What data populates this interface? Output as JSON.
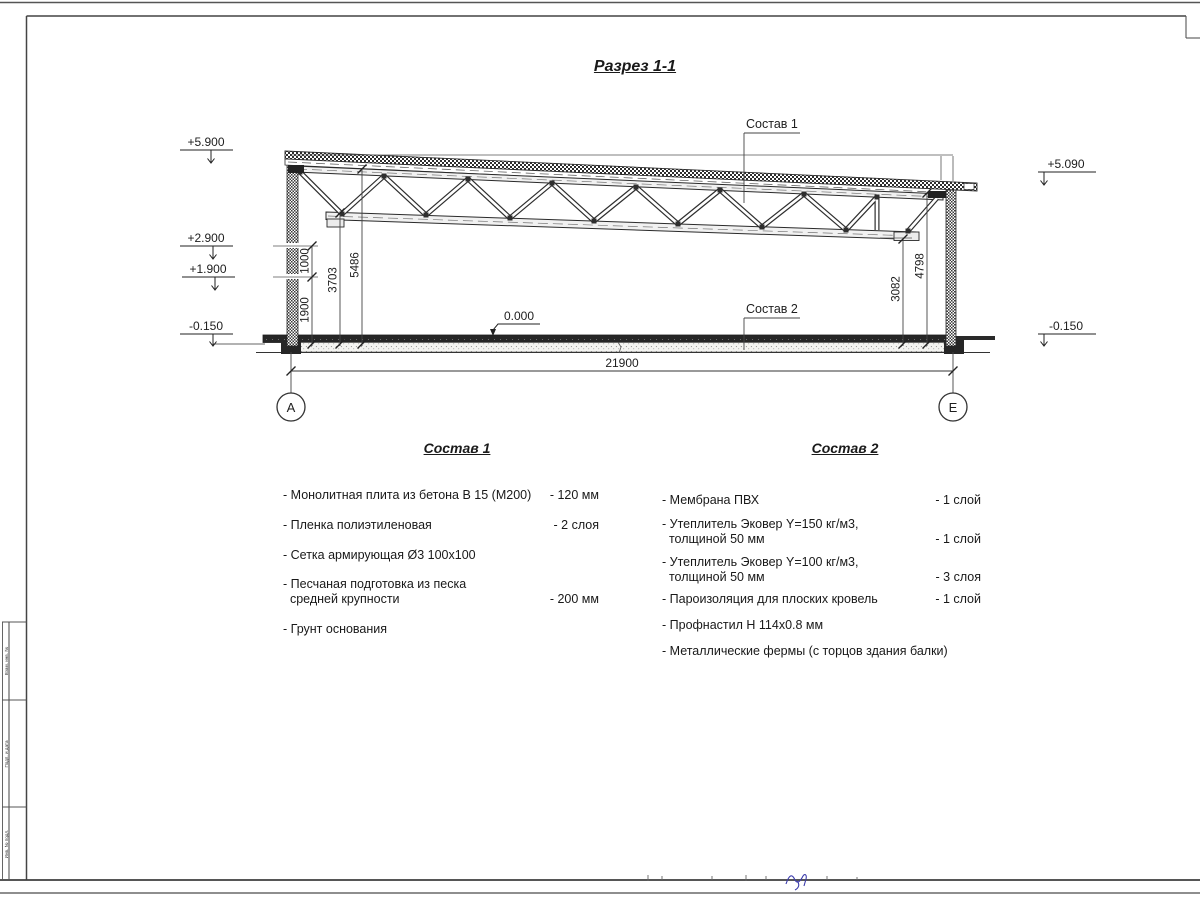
{
  "drawing": {
    "title": "Разрез 1-1",
    "labels": {
      "sostav1": "Состав 1",
      "sostav2": "Состав 2"
    },
    "elevations": {
      "left_top": "+5.900",
      "left_mid1": "+2.900",
      "left_mid2": "+1.900",
      "left_bottom": "-0.150",
      "right_top": "+5.090",
      "right_bottom": "-0.150",
      "floor_zero": "0.000"
    },
    "dimensions": {
      "total_width": "21900",
      "v1000": "1000",
      "v1900": "1900",
      "v3703": "3703",
      "v5486": "5486",
      "v3082": "3082",
      "v4798": "4798"
    },
    "axes": {
      "left": "А",
      "right": "Е"
    }
  },
  "spec1": {
    "heading": "Состав 1",
    "items": [
      {
        "name": "- Монолитная плита из бетона В 15 (М200)",
        "value": "- 120 мм"
      },
      {
        "name": "- Пленка полиэтиленовая",
        "value": "-  2 слоя"
      },
      {
        "name": "- Сетка армирующая Ø3 100х100",
        "value": ""
      },
      {
        "name": "- Песчаная подготовка из песка\n  средней крупности",
        "value": "- 200 мм"
      },
      {
        "name": "- Грунт основания",
        "value": ""
      }
    ]
  },
  "spec2": {
    "heading": "Состав 2",
    "items": [
      {
        "name": "- Мембрана ПВХ",
        "value": "- 1 слой"
      },
      {
        "name": "- Утеплитель Эковер Y=150 кг/м3,\n  толщиной 50 мм",
        "value": "- 1 слой"
      },
      {
        "name": "- Утеплитель Эковер Y=100 кг/м3,\n  толщиной 50 мм",
        "value": "- 3 слоя"
      },
      {
        "name": "- Пароизоляция для плоских кровель",
        "value": "- 1 слой"
      },
      {
        "name": "- Профнастил Н 114х0.8 мм",
        "value": ""
      },
      {
        "name": "- Металлические фермы (с торцов здания балки)",
        "value": ""
      }
    ]
  },
  "frame": {
    "stamp_labels": [
      "Взам. инв. №",
      "Подп. и дата",
      "Инв. № подл."
    ]
  }
}
